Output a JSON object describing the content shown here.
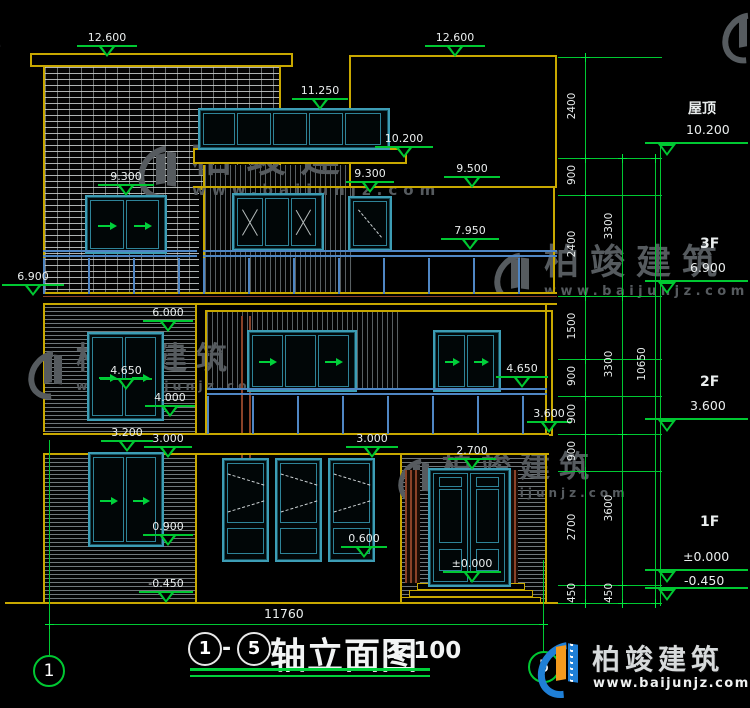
{
  "elev": {
    "m12600a": "12.600",
    "m12600b": "12.600",
    "m11250": "11.250",
    "m10200a": "10.200",
    "m9500": "9.500",
    "m9300a": "9.300",
    "m9300b": "9.300",
    "m7950": "7.950",
    "m6900": "6.900",
    "m6000": "6.000",
    "m4650a": "4.650",
    "m4650b": "4.650",
    "m4000": "4.000",
    "m3600": "3.600",
    "m3200": "3.200",
    "m3000a": "3.000",
    "m3000b": "3.000",
    "m2700": "2.700",
    "m0900": "0.900",
    "m0600": "0.600",
    "m0000": "±0.000",
    "mneg450": "-0.450"
  },
  "dims": {
    "c1": [
      "2400",
      "900",
      "2400",
      "1500",
      "900",
      "900",
      "900",
      "2700",
      "450"
    ],
    "c2": [
      "3300",
      "3300",
      "3600",
      "450"
    ],
    "c3": "10650",
    "total_width": "11760"
  },
  "levels": {
    "roof_label": "屋顶",
    "roof_value": "10.200",
    "f3_label": "3F",
    "f3_value": "6.900",
    "f2_label": "2F",
    "f2_value": "3.600",
    "f1_label": "1F",
    "f1_value": "±0.000",
    "below_ground": "-0.450"
  },
  "axes": {
    "start": "1",
    "end": "5"
  },
  "title": {
    "axis_start": "1",
    "separator": "-",
    "axis_end": "5",
    "name": "轴立面图",
    "scale": "1:100"
  },
  "watermark": {
    "name": "柏竣建筑",
    "url": "www.baijunjz.com"
  },
  "brand": {
    "name": "柏竣建筑",
    "url": "www.baijunjz.com"
  }
}
